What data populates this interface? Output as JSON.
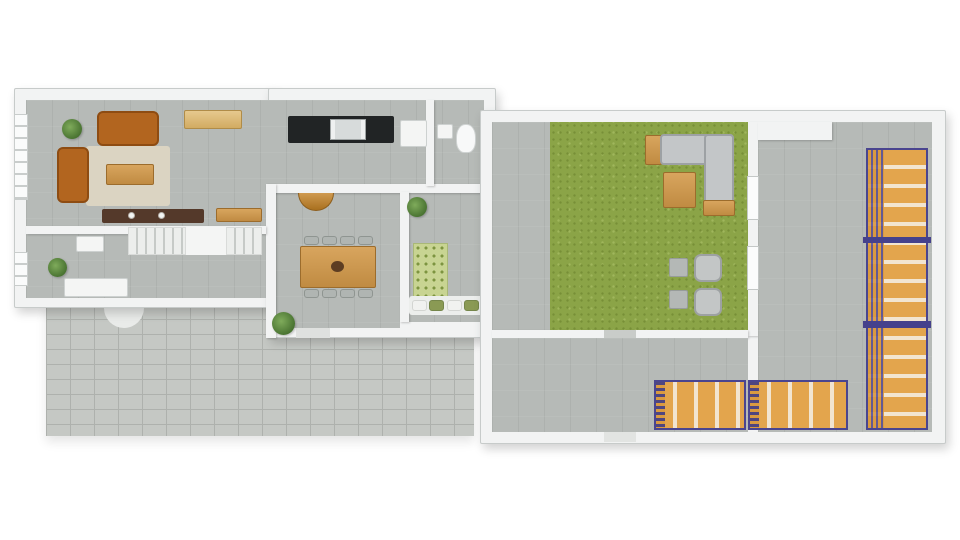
{
  "palette": {
    "background": "#ffffff",
    "wall_white": "#f2f3f3",
    "floor_gray": "#b6bab7",
    "paver_gray": "#c5c8c4",
    "grass_green": "#8ba447",
    "sofa_brown": "#b2651f",
    "sofa_gray": "#c3c6c8",
    "wood_tan": "#d8a55e",
    "rack_orange": "#e3a54d",
    "rack_frame_blue": "#4a458f",
    "counter_black": "#212425",
    "rug_beige": "#dbd4c2",
    "rug_green_pattern": "#c8d492",
    "dark_sideboard": "#54392a"
  },
  "scene": {
    "canvas": {
      "w": 960,
      "h": 540
    },
    "elements": [
      {
        "n": "patio-pavers",
        "c": "pavers",
        "x": 46,
        "y": 304,
        "w": 428,
        "h": 132
      },
      {
        "n": "entry-step",
        "c": "solid",
        "x": 104,
        "y": 298,
        "w": 40,
        "h": 30,
        "bg": "#e9ebe9",
        "r": "0 0 20px 20px"
      },
      {
        "n": "house-wall-left-block",
        "c": "wall",
        "x": 14,
        "y": 88,
        "w": 260,
        "h": 220
      },
      {
        "n": "house-wall-right-block",
        "c": "wall",
        "x": 268,
        "y": 88,
        "w": 228,
        "h": 250
      },
      {
        "n": "floor-living-kitchen",
        "c": "floor",
        "x": 26,
        "y": 100,
        "w": 458,
        "h": 92
      },
      {
        "n": "floor-living-lower",
        "c": "floor",
        "x": 26,
        "y": 192,
        "w": 240,
        "h": 38
      },
      {
        "n": "floor-hall",
        "c": "floor",
        "x": 26,
        "y": 234,
        "w": 240,
        "h": 64
      },
      {
        "n": "floor-dining",
        "c": "floor",
        "x": 276,
        "y": 192,
        "w": 124,
        "h": 136
      },
      {
        "n": "floor-bedroom",
        "c": "floor",
        "x": 408,
        "y": 192,
        "w": 76,
        "h": 130
      },
      {
        "n": "wall-kitchen-dining",
        "c": "iwall",
        "x": 266,
        "y": 184,
        "w": 218,
        "h": 9
      },
      {
        "n": "wall-hall-dining",
        "c": "iwall",
        "x": 266,
        "y": 184,
        "w": 10,
        "h": 154
      },
      {
        "n": "wall-dining-bedroom",
        "c": "iwall",
        "x": 400,
        "y": 192,
        "w": 9,
        "h": 130
      },
      {
        "n": "wall-living-hall",
        "c": "iwall",
        "x": 26,
        "y": 226,
        "w": 240,
        "h": 8
      },
      {
        "n": "wall-kitchen-bath",
        "c": "iwall",
        "x": 426,
        "y": 100,
        "w": 8,
        "h": 86
      },
      {
        "n": "door-dining-patio",
        "c": "solid",
        "x": 296,
        "y": 328,
        "w": 34,
        "h": 10,
        "bg": "#dfe1df"
      },
      {
        "n": "window-living",
        "c": "window",
        "x": 14,
        "y": 114,
        "w": 14,
        "h": 86
      },
      {
        "n": "window-hall",
        "c": "window",
        "x": 14,
        "y": 252,
        "w": 14,
        "h": 34
      },
      {
        "n": "staircase-winder",
        "c": "steps",
        "x": 128,
        "y": 227,
        "w": 58,
        "h": 28
      },
      {
        "n": "staircase-landing",
        "c": "solid",
        "x": 186,
        "y": 227,
        "w": 40,
        "h": 28,
        "bg": "#f4f5f4"
      },
      {
        "n": "staircase-straight",
        "c": "steps",
        "x": 226,
        "y": 227,
        "w": 36,
        "h": 28
      },
      {
        "n": "plant-living",
        "c": "plant",
        "x": 62,
        "y": 119,
        "w": 20,
        "h": 20
      },
      {
        "n": "rug-living",
        "c": "solid",
        "x": 86,
        "y": 146,
        "w": 84,
        "h": 60,
        "bg": "#dbd4c2",
        "r": "3px"
      },
      {
        "n": "sofa-top",
        "c": "sofaBrown",
        "x": 97,
        "y": 111,
        "w": 62,
        "h": 35
      },
      {
        "n": "sofa-left",
        "c": "sofaBrown",
        "x": 57,
        "y": 147,
        "w": 32,
        "h": 56
      },
      {
        "n": "coffee-table",
        "c": "wood",
        "x": 106,
        "y": 164,
        "w": 48,
        "h": 21
      },
      {
        "n": "sideboard-light",
        "c": "woodLight",
        "x": 184,
        "y": 110,
        "w": 58,
        "h": 19
      },
      {
        "n": "sideboard-dark",
        "c": "solid",
        "x": 102,
        "y": 209,
        "w": 102,
        "h": 14,
        "bg": "#54392a",
        "r": "2px"
      },
      {
        "n": "vase-1",
        "c": "dot",
        "x": 128,
        "y": 212,
        "w": 7,
        "h": 7
      },
      {
        "n": "vase-2",
        "c": "dot",
        "x": 158,
        "y": 212,
        "w": 7,
        "h": 7
      },
      {
        "n": "console-wood",
        "c": "wood",
        "x": 216,
        "y": 208,
        "w": 46,
        "h": 14
      },
      {
        "n": "kitchen-counter",
        "c": "solid",
        "x": 288,
        "y": 116,
        "w": 106,
        "h": 27,
        "bg": "#212425",
        "r": "2px"
      },
      {
        "n": "kitchen-sink",
        "c": "sink",
        "x": 330,
        "y": 119,
        "w": 36,
        "h": 21
      },
      {
        "n": "fridge",
        "c": "appliance",
        "x": 400,
        "y": 120,
        "w": 27,
        "h": 27
      },
      {
        "n": "bath-sink",
        "c": "appliance",
        "x": 437,
        "y": 124,
        "w": 16,
        "h": 15
      },
      {
        "n": "toilet",
        "c": "toilet",
        "x": 456,
        "y": 124,
        "w": 20,
        "h": 29
      },
      {
        "n": "hall-cabinet",
        "c": "appliance",
        "x": 76,
        "y": 236,
        "w": 28,
        "h": 16
      },
      {
        "n": "hall-desk",
        "c": "appliance",
        "x": 64,
        "y": 278,
        "w": 64,
        "h": 19
      },
      {
        "n": "plant-hall",
        "c": "plant",
        "x": 48,
        "y": 258,
        "w": 19,
        "h": 19
      },
      {
        "n": "console-halfround",
        "c": "woodHalf",
        "x": 298,
        "y": 193,
        "w": 36,
        "h": 18
      },
      {
        "n": "dining-table",
        "c": "wood",
        "x": 300,
        "y": 246,
        "w": 76,
        "h": 42
      },
      {
        "n": "dining-centerpiece",
        "c": "dotDark",
        "x": 331,
        "y": 261,
        "w": 13,
        "h": 11
      },
      {
        "n": "dining-chair-1",
        "c": "chair",
        "x": 304,
        "y": 236,
        "w": 15,
        "h": 9
      },
      {
        "n": "dining-chair-2",
        "c": "chair",
        "x": 322,
        "y": 236,
        "w": 15,
        "h": 9
      },
      {
        "n": "dining-chair-3",
        "c": "chair",
        "x": 340,
        "y": 236,
        "w": 15,
        "h": 9
      },
      {
        "n": "dining-chair-4",
        "c": "chair",
        "x": 358,
        "y": 236,
        "w": 15,
        "h": 9
      },
      {
        "n": "dining-chair-5",
        "c": "chair",
        "x": 304,
        "y": 289,
        "w": 15,
        "h": 9
      },
      {
        "n": "dining-chair-6",
        "c": "chair",
        "x": 322,
        "y": 289,
        "w": 15,
        "h": 9
      },
      {
        "n": "dining-chair-7",
        "c": "chair",
        "x": 340,
        "y": 289,
        "w": 15,
        "h": 9
      },
      {
        "n": "dining-chair-8",
        "c": "chair",
        "x": 358,
        "y": 289,
        "w": 15,
        "h": 9
      },
      {
        "n": "plant-bedroom",
        "c": "plant",
        "x": 407,
        "y": 197,
        "w": 20,
        "h": 20
      },
      {
        "n": "rug-bedroom",
        "c": "rugGreen",
        "x": 413,
        "y": 243,
        "w": 35,
        "h": 54
      },
      {
        "n": "bench-bedroom",
        "c": "solid",
        "x": 409,
        "y": 296,
        "w": 74,
        "h": 19,
        "bg": "#eceeec",
        "r": "3px"
      },
      {
        "n": "pillow-1",
        "c": "pillowW",
        "x": 412,
        "y": 300,
        "w": 15,
        "h": 11
      },
      {
        "n": "pillow-2",
        "c": "pillowG",
        "x": 429,
        "y": 300,
        "w": 15,
        "h": 11
      },
      {
        "n": "pillow-3",
        "c": "pillowW",
        "x": 447,
        "y": 300,
        "w": 15,
        "h": 11
      },
      {
        "n": "pillow-4",
        "c": "pillowG",
        "x": 464,
        "y": 300,
        "w": 15,
        "h": 11
      },
      {
        "n": "plant-patio",
        "c": "plant",
        "x": 272,
        "y": 312,
        "w": 23,
        "h": 23
      },
      {
        "n": "warehouse-wall",
        "c": "wall",
        "x": 480,
        "y": 110,
        "w": 466,
        "h": 334
      },
      {
        "n": "floor-entry-strip",
        "c": "floor",
        "x": 492,
        "y": 122,
        "w": 58,
        "h": 214
      },
      {
        "n": "floor-green-room",
        "c": "grass",
        "x": 550,
        "y": 122,
        "w": 198,
        "h": 214
      },
      {
        "n": "wall-green-right",
        "c": "iwall",
        "x": 748,
        "y": 122,
        "w": 10,
        "h": 214
      },
      {
        "n": "floor-warehouse",
        "c": "floor",
        "x": 758,
        "y": 122,
        "w": 174,
        "h": 310
      },
      {
        "n": "beam-top-warehouse",
        "c": "iwall",
        "x": 758,
        "y": 122,
        "w": 74,
        "h": 18
      },
      {
        "n": "wall-green-bottom",
        "c": "iwall",
        "x": 492,
        "y": 330,
        "w": 256,
        "h": 8
      },
      {
        "n": "threshold-green",
        "c": "solid",
        "x": 604,
        "y": 330,
        "w": 32,
        "h": 8,
        "bg": "#c9ccc9"
      },
      {
        "n": "floor-corridor",
        "c": "floor",
        "x": 492,
        "y": 338,
        "w": 256,
        "h": 94
      },
      {
        "n": "door-green-1",
        "c": "door",
        "x": 747,
        "y": 176,
        "w": 12,
        "h": 44
      },
      {
        "n": "door-green-2",
        "c": "door",
        "x": 747,
        "y": 246,
        "w": 12,
        "h": 44
      },
      {
        "n": "threshold-bottom",
        "c": "solid",
        "x": 604,
        "y": 432,
        "w": 32,
        "h": 10,
        "bg": "#e2e4e2"
      },
      {
        "n": "pallet-side-table",
        "c": "wood",
        "x": 645,
        "y": 135,
        "w": 17,
        "h": 30
      },
      {
        "n": "sofa-corner-top",
        "c": "sofaGray",
        "x": 660,
        "y": 134,
        "w": 74,
        "h": 31
      },
      {
        "n": "sofa-corner-right",
        "c": "sofaGray",
        "x": 704,
        "y": 134,
        "w": 30,
        "h": 80
      },
      {
        "n": "pallet-under-sofa",
        "c": "wood",
        "x": 703,
        "y": 200,
        "w": 32,
        "h": 16
      },
      {
        "n": "coffee-table-green",
        "c": "wood",
        "x": 663,
        "y": 172,
        "w": 33,
        "h": 36
      },
      {
        "n": "side-table-1",
        "c": "chairGray",
        "x": 669,
        "y": 258,
        "w": 19,
        "h": 19
      },
      {
        "n": "armchair-1",
        "c": "armchair",
        "x": 694,
        "y": 254,
        "w": 28,
        "h": 28
      },
      {
        "n": "side-table-2",
        "c": "chairGray",
        "x": 669,
        "y": 290,
        "w": 19,
        "h": 19
      },
      {
        "n": "armchair-2",
        "c": "armchair",
        "x": 694,
        "y": 288,
        "w": 28,
        "h": 28
      },
      {
        "n": "rack-wall",
        "c": "rackV",
        "x": 866,
        "y": 148,
        "w": 62,
        "h": 282
      },
      {
        "n": "rack-divider-1",
        "c": "solid",
        "x": 863,
        "y": 237,
        "w": 68,
        "h": 6,
        "bg": "#45418c"
      },
      {
        "n": "rack-divider-2",
        "c": "solid",
        "x": 863,
        "y": 321,
        "w": 68,
        "h": 7,
        "bg": "#45418c"
      },
      {
        "n": "rack-floor-1",
        "c": "rackH",
        "x": 654,
        "y": 380,
        "w": 92,
        "h": 50
      },
      {
        "n": "rack-floor-2",
        "c": "rackH",
        "x": 748,
        "y": 380,
        "w": 100,
        "h": 50
      }
    ]
  }
}
